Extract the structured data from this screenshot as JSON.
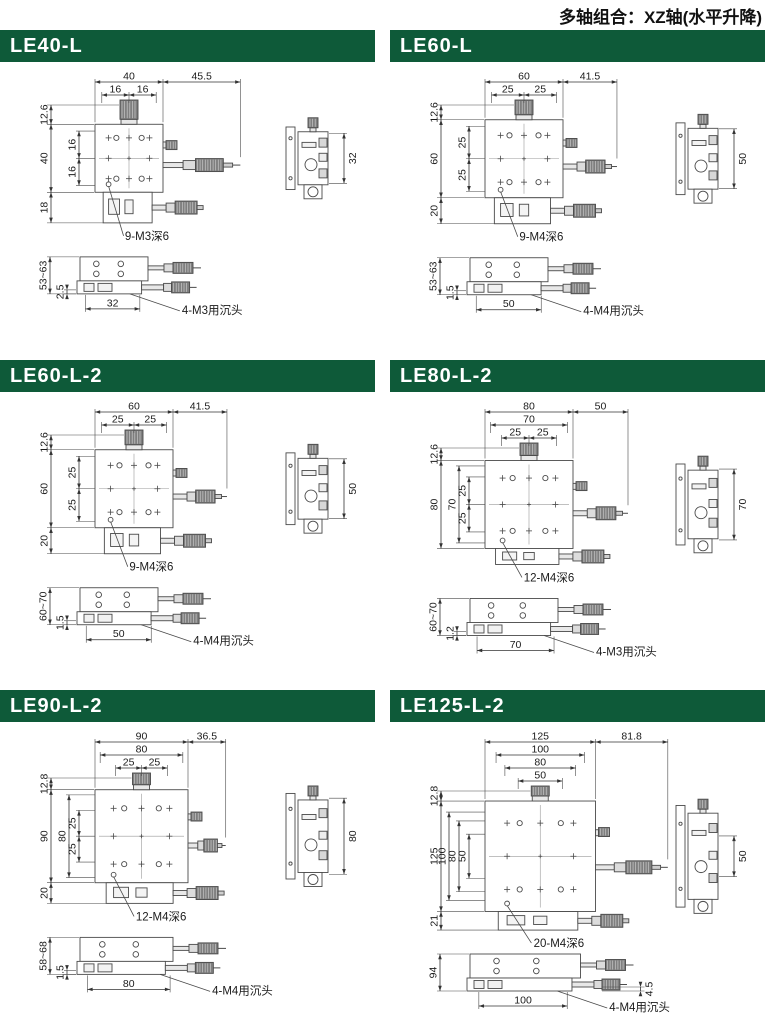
{
  "page": {
    "header": "多轴组合：XZ轴(水平升降)",
    "accent_color": "#0e5a39",
    "line_color": "#4a4a4a",
    "dim_color": "#333333",
    "text_color": "#1b1b1b",
    "metal_dark": "#7f7f7f",
    "metal_light": "#e8e8e8"
  },
  "panels": [
    {
      "title": "LE40-L",
      "front": {
        "width": "40",
        "ext": "45.5",
        "top_inner": [
          "16",
          "16"
        ],
        "left_top": "12.6",
        "left_main": "40",
        "left_inner": [
          "16",
          "16"
        ],
        "left_bottom": "18",
        "callout": "9-M3深6"
      },
      "side": {
        "dim": "32"
      },
      "bottom": {
        "height": "53~63",
        "offset": "2.5",
        "offset_side": "left",
        "width": "32",
        "callout": "4-M3用沉头"
      }
    },
    {
      "title": "LE60-L",
      "front": {
        "width": "60",
        "ext": "41.5",
        "top_inner": [
          "25",
          "25"
        ],
        "left_top": "12.6",
        "left_main": "60",
        "left_inner": [
          "25",
          "25"
        ],
        "left_bottom": "20",
        "callout": "9-M4深6"
      },
      "side": {
        "dim": "50"
      },
      "bottom": {
        "height": "53~63",
        "offset": "1.5",
        "offset_side": "left",
        "width": "50",
        "callout": "4-M4用沉头"
      }
    },
    {
      "title": "LE60-L-2",
      "front": {
        "width": "60",
        "ext": "41.5",
        "top_inner": [
          "25",
          "25"
        ],
        "left_top": "12.6",
        "left_main": "60",
        "left_inner": [
          "25",
          "25"
        ],
        "left_bottom": "20",
        "callout": "9-M4深6"
      },
      "side": {
        "dim": "50"
      },
      "bottom": {
        "height": "60~70",
        "offset": "1.5",
        "offset_side": "left",
        "width": "50",
        "callout": "4-M4用沉头"
      }
    },
    {
      "title": "LE80-L-2",
      "front": {
        "width": "80",
        "ext": "50",
        "top_inner": [
          "70",
          "25",
          "25"
        ],
        "left_top": "12.6",
        "left_main": "80",
        "left_inner": [
          "70",
          "25",
          "25"
        ],
        "left_bottom": null,
        "callout": "12-M4深6"
      },
      "side": {
        "dim": "70"
      },
      "bottom": {
        "height": "60~70",
        "offset": "1.2",
        "offset_side": "left",
        "width": "70",
        "callout": "4-M3用沉头"
      }
    },
    {
      "title": "LE90-L-2",
      "front": {
        "width": "90",
        "ext": "36.5",
        "top_inner": [
          "80",
          "25",
          "25"
        ],
        "left_top": "12.8",
        "left_main": "90",
        "left_inner": [
          "80",
          "25",
          "25"
        ],
        "left_bottom": "20",
        "callout": "12-M4深6"
      },
      "side": {
        "dim": "80"
      },
      "bottom": {
        "height": "58~68",
        "offset": "1.5",
        "offset_side": "left",
        "width": "80",
        "callout": "4-M4用沉头"
      }
    },
    {
      "title": "LE125-L-2",
      "front": {
        "width": "125",
        "ext": "81.8",
        "top_inner": [
          "100",
          "80",
          "50"
        ],
        "left_top": "12.8",
        "left_main": "125",
        "left_inner": [
          "100",
          "80",
          "50"
        ],
        "left_bottom": "21",
        "callout": "20-M4深6"
      },
      "side": {
        "dim": "50"
      },
      "bottom": {
        "height": "94",
        "offset": "4.5",
        "offset_side": "right",
        "width": "100",
        "callout": "4-M4用沉头"
      }
    }
  ]
}
